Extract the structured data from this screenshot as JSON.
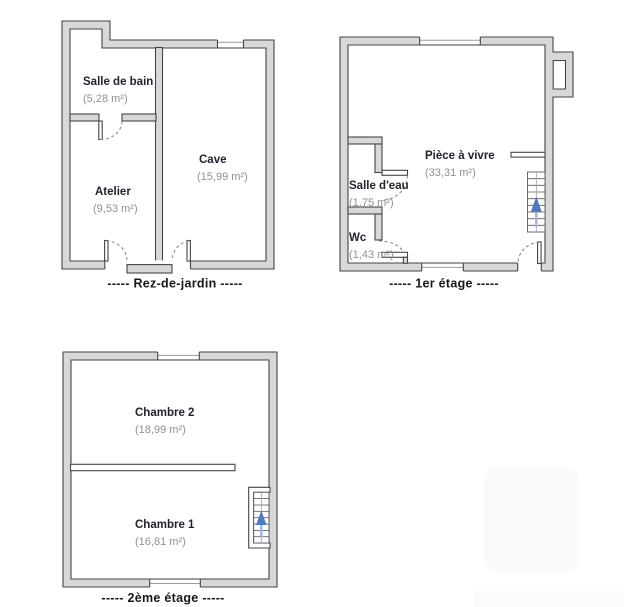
{
  "document_type": "floor-plan",
  "floors": [
    {
      "label": "Rez-de-jardin",
      "display_label": "-----  Rez-de-jardin  -----",
      "rooms": [
        {
          "name": "Salle de bain",
          "area": "(5,28 m²)"
        },
        {
          "name": "Cave",
          "area": "(15,99 m²)"
        },
        {
          "name": "Atelier",
          "area": "(9,53 m²)"
        }
      ]
    },
    {
      "label": "1er étage",
      "display_label": "-----  1er étage  -----",
      "rooms": [
        {
          "name": "Pièce à vivre",
          "area": "(33,31 m²)"
        },
        {
          "name": "Salle d'eau",
          "area": "(1,75 m²)"
        },
        {
          "name": "Wc",
          "area": "(1,43 m²)"
        }
      ]
    },
    {
      "label": "2ème étage",
      "display_label": "-----  2ème étage  -----",
      "rooms": [
        {
          "name": "Chambre 2",
          "area": "(18,99 m²)"
        },
        {
          "name": "Chambre 1",
          "area": "(16,81 m²)"
        }
      ]
    }
  ],
  "icons": {
    "stairs_arrow": "up-arrow"
  },
  "colors": {
    "wall-fill": "#d8d8d8",
    "wall-stroke": "#45454a",
    "room-name-color": "#23232e",
    "area-color": "#8e9095",
    "floor-label-color": "#18181b",
    "stairs-arrow-color": "#4f79c0",
    "stairs-arrow-stem-color": "#a7b8dc",
    "door-arc-color": "#8d8d92",
    "window-line-color": "#9b9ba0"
  }
}
